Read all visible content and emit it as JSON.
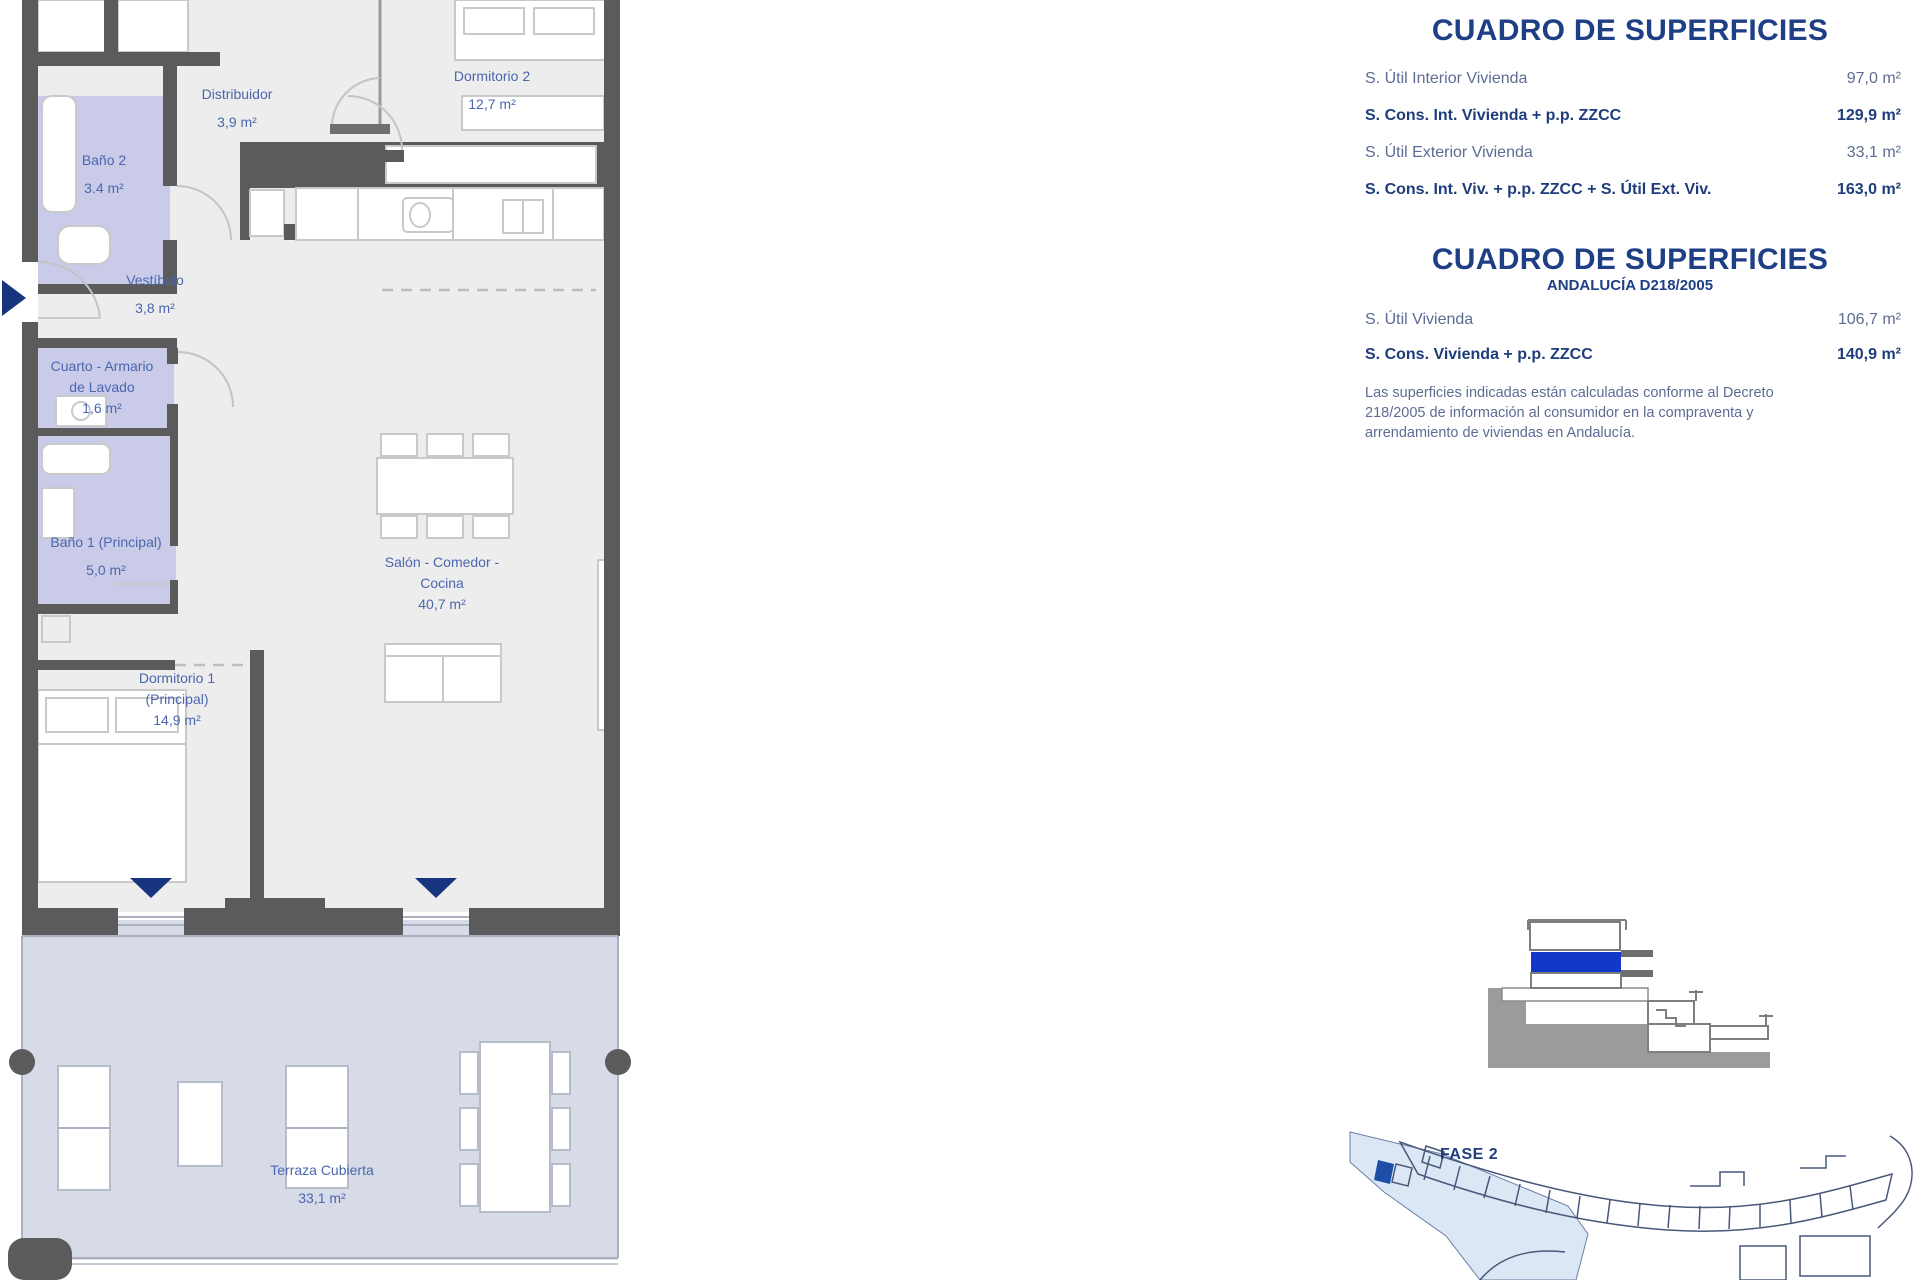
{
  "colors": {
    "wall": "#5b5b5b",
    "floor": "#ededed",
    "bath": "#c9cbe8",
    "terrace": "#d7dbe7",
    "label-blue": "#4a67ad",
    "title-navy": "#1e3f85",
    "row-blue": "#5d6c93",
    "bold-navy": "#1f3d7c",
    "highlight-blue": "#1238c8",
    "navy": "#16357e",
    "site-blue": "#dbe7f5",
    "site-unit": "#1d4fa8"
  },
  "plan": {
    "rooms": [
      {
        "lines": [
          "Distribuidor"
        ],
        "area": "3,9 m²"
      },
      {
        "lines": [
          "Dormitorio 2"
        ],
        "area": "12,7 m²"
      },
      {
        "lines": [
          "Baño 2"
        ],
        "area": "3.4 m²"
      },
      {
        "lines": [
          "Vestíbulo"
        ],
        "area": "3,8 m²"
      },
      {
        "lines": [
          "Cuarto - Armario",
          "de Lavado"
        ],
        "area": "1,6 m²"
      },
      {
        "lines": [
          "Baño 1 (Principal)"
        ],
        "area": "5,0 m²"
      },
      {
        "lines": [
          "Salón - Comedor -",
          "Cocina"
        ],
        "area": "40,7 m²"
      },
      {
        "lines": [
          "Dormitorio 1",
          "(Principal)"
        ],
        "area": "14,9 m²"
      },
      {
        "lines": [
          "Terraza Cubierta"
        ],
        "area": "33,1 m²"
      }
    ]
  },
  "tables": [
    {
      "title": "CUADRO DE SUPERFICIES",
      "rows": [
        {
          "label": "S. Útil Interior Vivienda",
          "value": "97,0 m²"
        },
        {
          "label": "S. Cons. Int. Vivienda + p.p. ZZCC",
          "value": "129,9 m²"
        },
        {
          "label": "S. Útil Exterior Vivienda",
          "value": "33,1 m²"
        },
        {
          "label": "S. Cons. Int. Viv. + p.p. ZZCC + S. Útil Ext. Viv.",
          "value": "163,0 m²"
        }
      ]
    },
    {
      "title": "CUADRO DE SUPERFICIES",
      "subtitle": "ANDALUCÍA D218/2005",
      "rows": [
        {
          "label": "S. Útil Vivienda",
          "value": "106,7 m²"
        },
        {
          "label": "S. Cons. Vivienda + p.p. ZZCC",
          "value": "140,9 m²"
        }
      ],
      "note_lines": [
        "Las superficies indicadas están calculadas conforme al Decreto",
        "218/2005 de información al consumidor en la compraventa y",
        "arrendamiento de viviendas en Andalucía."
      ]
    }
  ],
  "site_plan": {
    "phase_label": "FASE 2"
  }
}
